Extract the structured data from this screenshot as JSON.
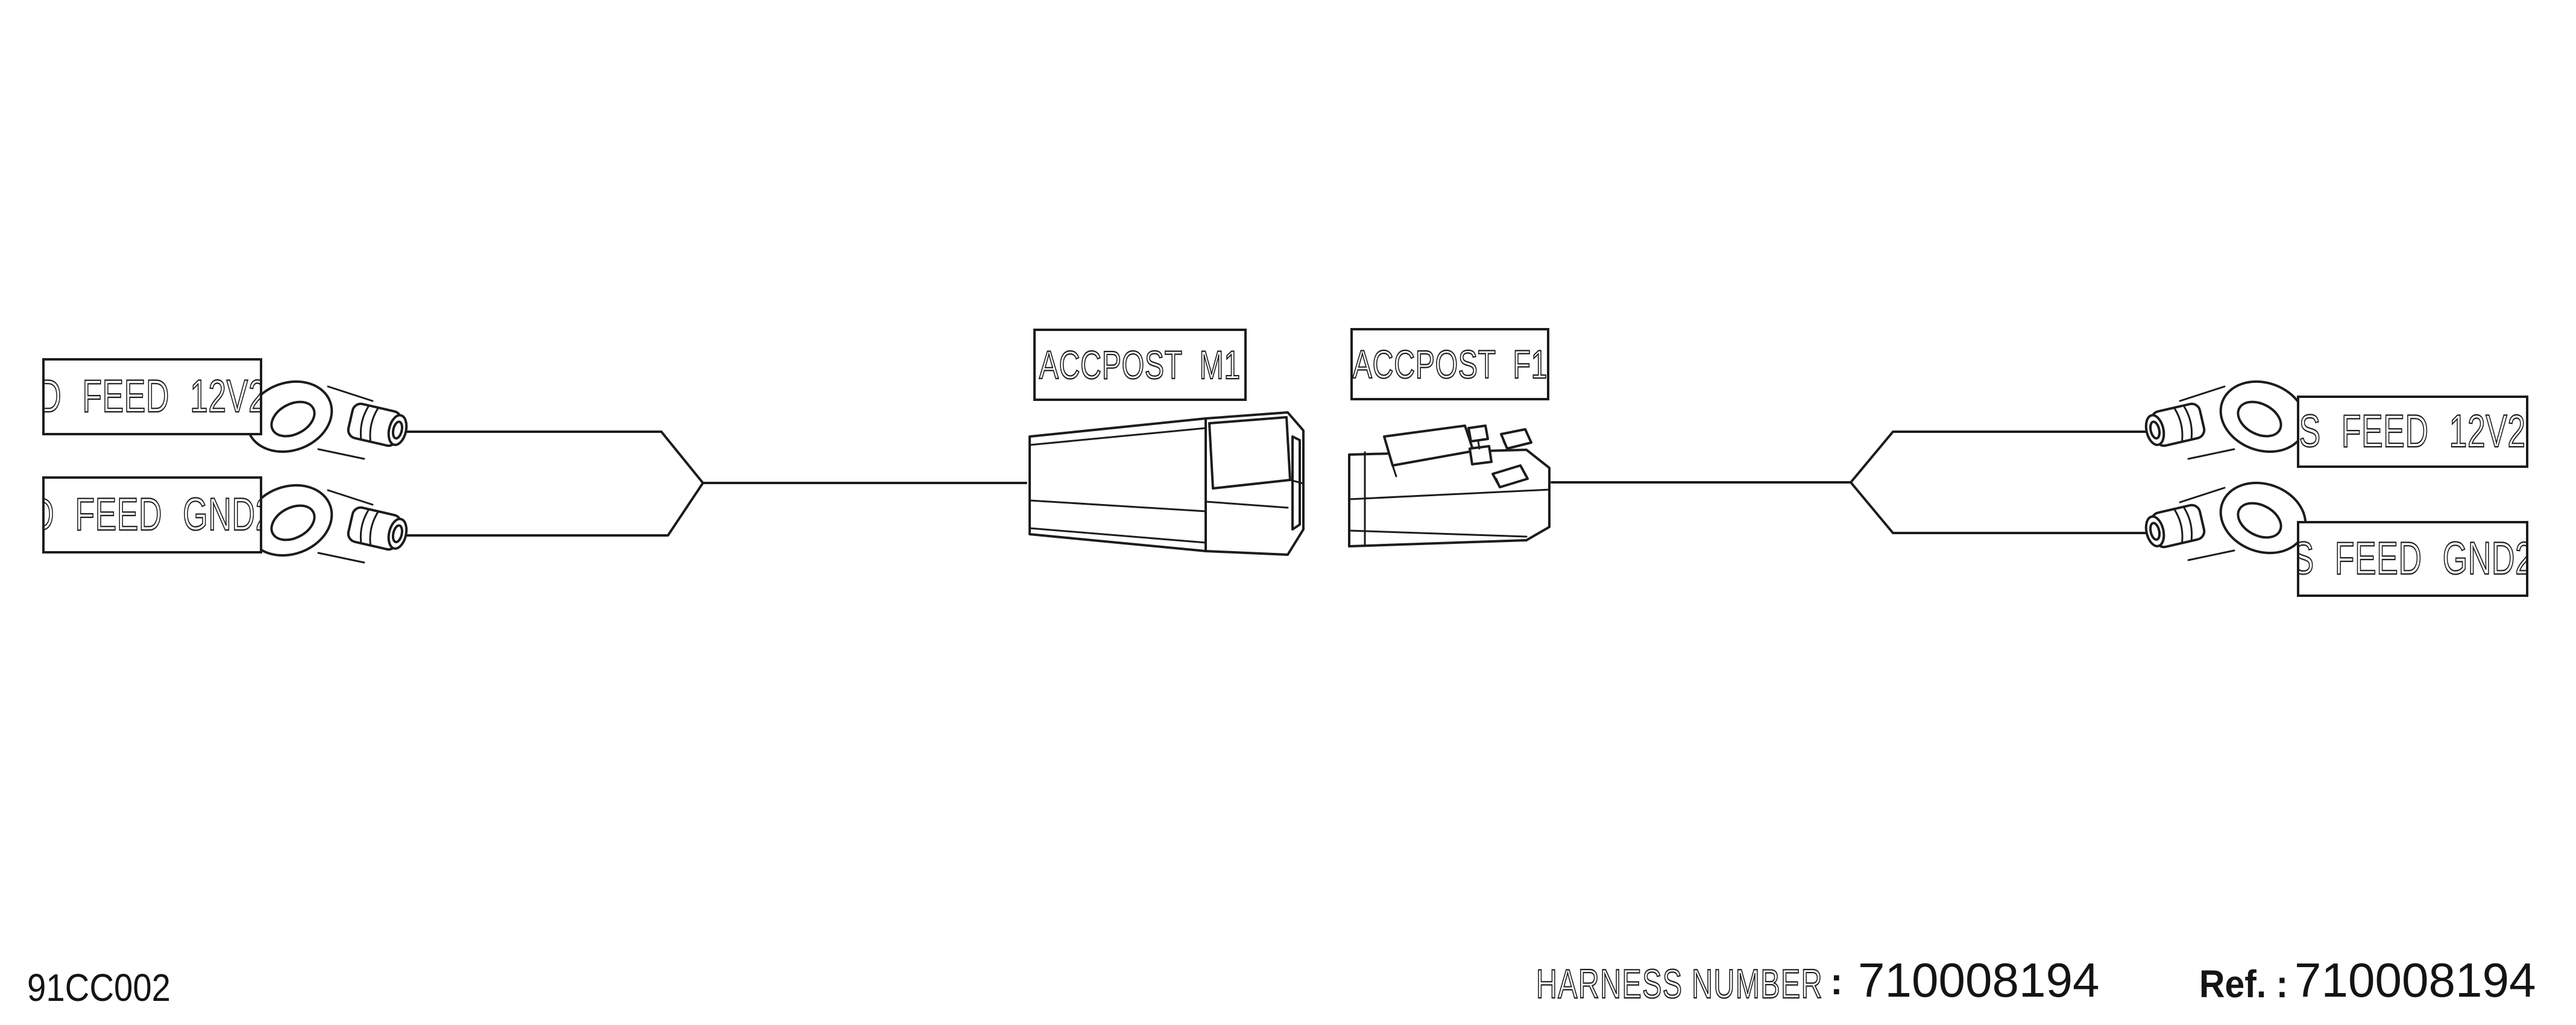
{
  "diagram": {
    "left_labels": [
      {
        "id": "d-feed-12v2",
        "text": "D FEED 12V2"
      },
      {
        "id": "d-feed-gnd2",
        "text": "D FEED GND2"
      }
    ],
    "connector_labels": [
      {
        "id": "accpost-m1",
        "text": "ACCPOST M1"
      },
      {
        "id": "accpost-f1",
        "text": "ACCPOST F1"
      }
    ],
    "right_labels": [
      {
        "id": "s-feed-12v2",
        "text": "S FEED 12V2"
      },
      {
        "id": "s-feed-gnd2",
        "text": "S FEED GND2"
      }
    ]
  },
  "footer": {
    "drawing_code": "91CC002",
    "harness_number_label": "HARNESS NUMBER",
    "harness_number_separator": ":",
    "harness_number_value": "710008194",
    "ref_label": "Ref. :",
    "ref_value": "710008194"
  },
  "colors": {
    "ink": "#1c1c1c",
    "background": "#ffffff"
  }
}
